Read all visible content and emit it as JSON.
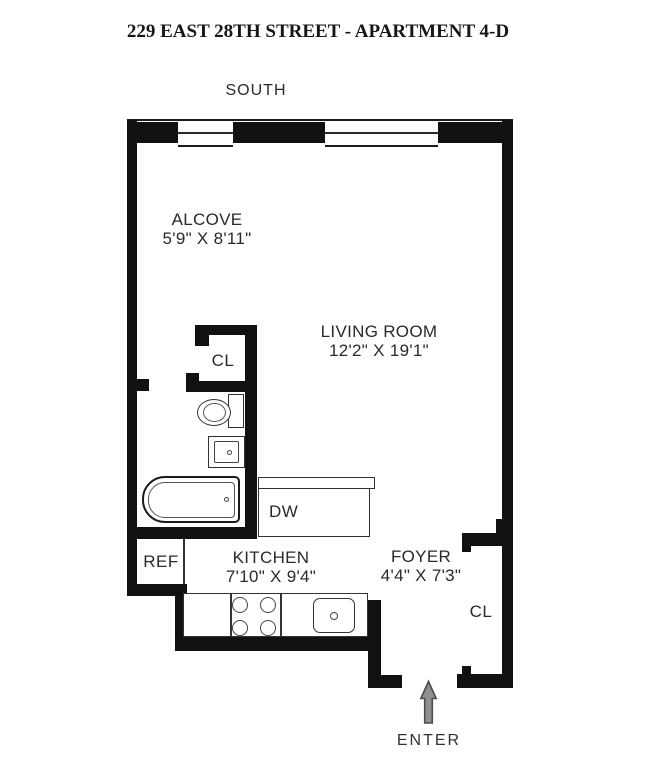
{
  "title": "229 EAST 28TH STREET - APARTMENT 4-D",
  "orientation_label": "SOUTH",
  "enter_label": "ENTER",
  "rooms": {
    "alcove": {
      "name": "ALCOVE",
      "dimensions": "5'9\" X 8'11\""
    },
    "living_room": {
      "name": "LIVING ROOM",
      "dimensions": "12'2\" X 19'1\""
    },
    "kitchen": {
      "name": "KITCHEN",
      "dimensions": "7'10\" X 9'4\""
    },
    "foyer": {
      "name": "FOYER",
      "dimensions": "4'4\" X 7'3\""
    }
  },
  "labels": {
    "closet_hall": "CL",
    "closet_foyer": "CL",
    "dishwasher": "DW",
    "refrigerator": "REF"
  },
  "colors": {
    "wall": "#111111",
    "text": "#2a2a2a",
    "fixture_line": "#444444",
    "arrow_fill": "#8f8f8f",
    "arrow_outline": "#4c4c4c"
  }
}
